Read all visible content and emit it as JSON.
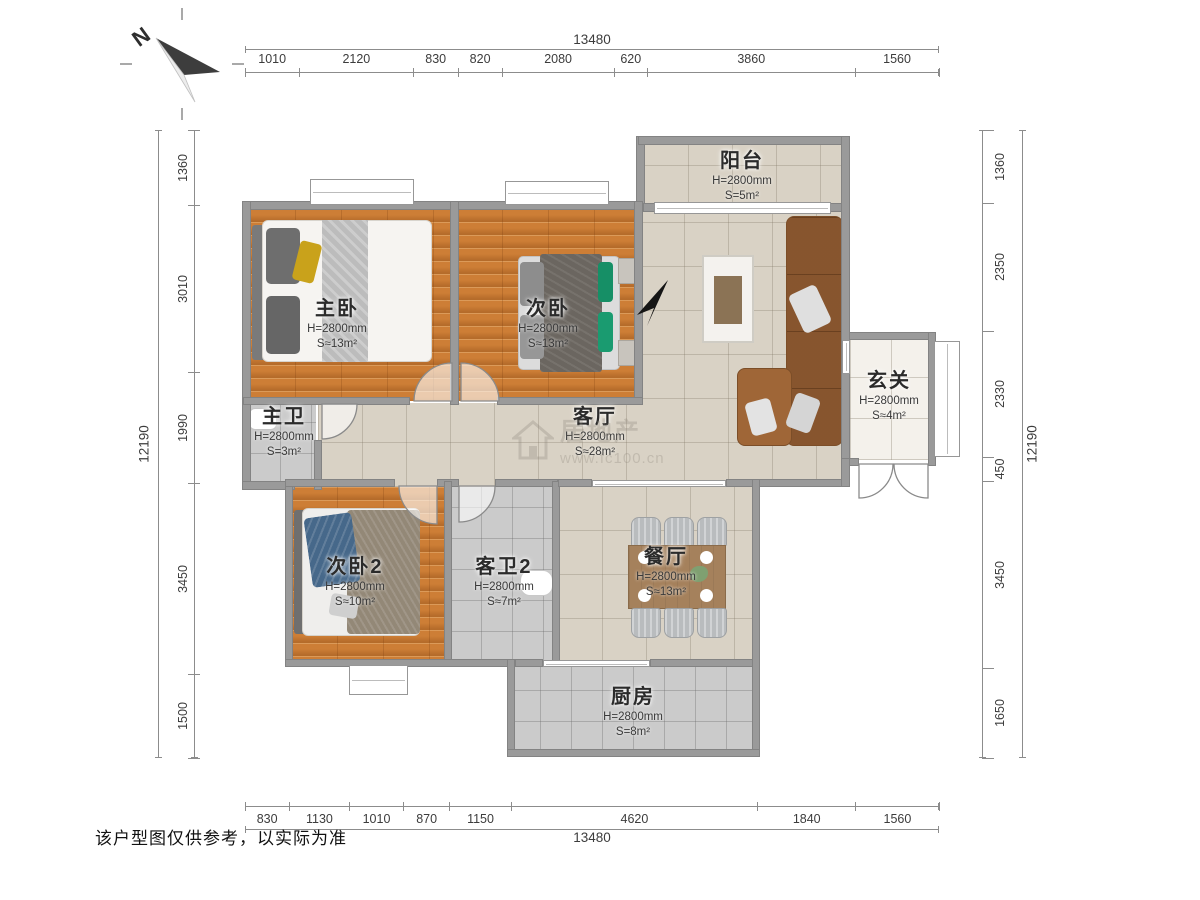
{
  "compass": {
    "north_label": "N"
  },
  "dims": {
    "top": {
      "total": "13480",
      "segments": [
        "1010",
        "2120",
        "830",
        "820",
        "2080",
        "620",
        "3860",
        "1560"
      ]
    },
    "bottom": {
      "total": "13480",
      "segments": [
        "830",
        "1130",
        "1010",
        "870",
        "1150",
        "4620",
        "1840",
        "1560"
      ]
    },
    "left": {
      "total": "12190",
      "segments": [
        "1360",
        "3010",
        "1990",
        "3450",
        "1500"
      ]
    },
    "right": {
      "total": "12190",
      "segments": [
        "1360",
        "2350",
        "2330",
        "450",
        "3450",
        "1650"
      ]
    }
  },
  "rooms": {
    "master": {
      "name": "主卧",
      "h": "H=2800mm",
      "s": "S≈13m²"
    },
    "bed2": {
      "name": "次卧",
      "h": "H=2800mm",
      "s": "S≈13m²"
    },
    "balcony": {
      "name": "阳台",
      "h": "H=2800mm",
      "s": "S=5m²"
    },
    "hall": {
      "name": "玄关",
      "h": "H=2800mm",
      "s": "S≈4m²"
    },
    "bath1": {
      "name": "主卫",
      "h": "H=2800mm",
      "s": "S=3m²"
    },
    "living": {
      "name": "客厅",
      "h": "H=2800mm",
      "s": "S≈28m²"
    },
    "bed3": {
      "name": "次卧2",
      "h": "H=2800mm",
      "s": "S≈10m²"
    },
    "bath2": {
      "name": "客卫2",
      "h": "H=2800mm",
      "s": "S≈7m²"
    },
    "dining": {
      "name": "餐厅",
      "h": "H=2800mm",
      "s": "S≈13m²"
    },
    "kitchen": {
      "name": "厨房",
      "h": "H=2800mm",
      "s": "S=8m²"
    }
  },
  "watermark": {
    "brand": "居地产",
    "url": "www.fc100.cn"
  },
  "footer": {
    "disclaimer": "该户型图仅供参考，以实际为准"
  }
}
